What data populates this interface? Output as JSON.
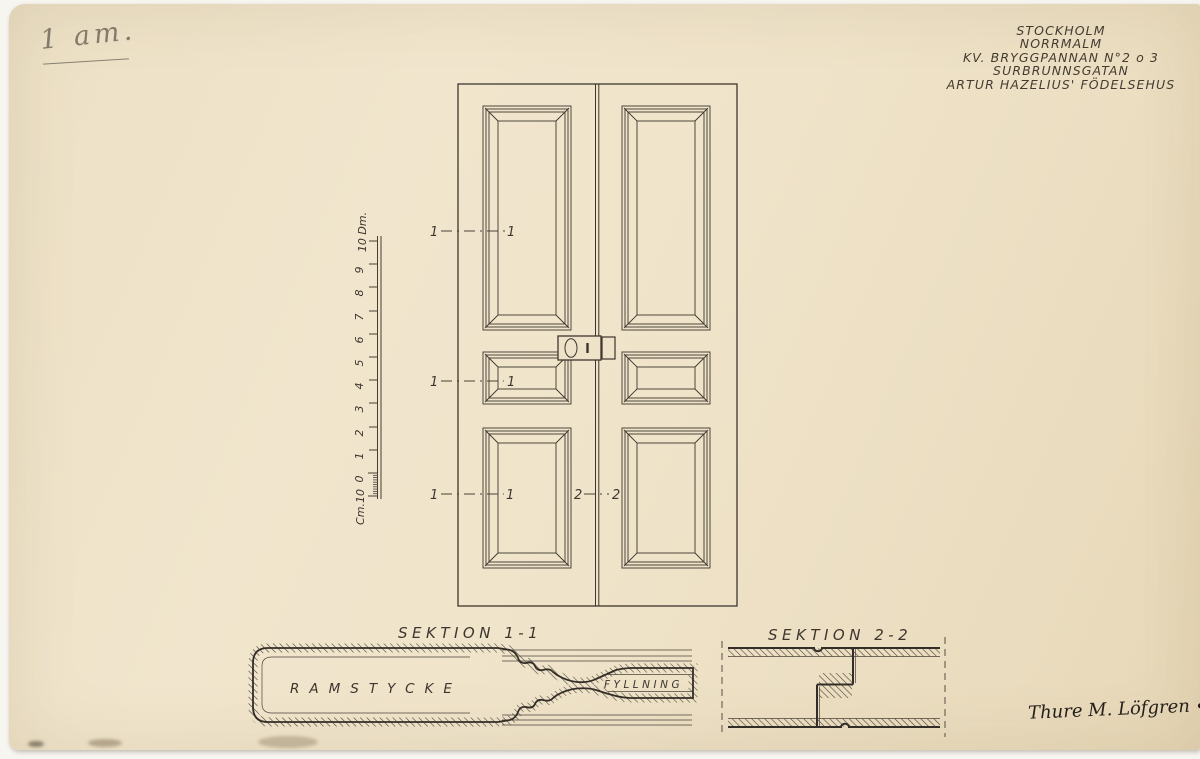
{
  "colors": {
    "paper": "#eee2c8",
    "ink": "#38322b",
    "pencil": "#847b6c"
  },
  "pencil_note": {
    "text": "1 am."
  },
  "title_block": {
    "lines": [
      "STOCKHOLM",
      "NORRMALM",
      "KV. BRYGGPANNAN N°2 o 3",
      "SURBRUNNSGATAN",
      "ARTUR HAZELIUS' FÖDELSEHUS"
    ]
  },
  "scale_ruler": {
    "unit_bottom": "Cm.10",
    "numbers": [
      "0",
      "1",
      "2",
      "3",
      "4",
      "5",
      "6",
      "7",
      "8",
      "9"
    ],
    "unit_top": "10 Dm."
  },
  "elevation": {
    "cut_line_1": "1",
    "cut_line_2": "2"
  },
  "sections": {
    "section1": {
      "title": "SEKTION 1-1",
      "frame_label": "RAMSTYCKE",
      "panel_label": "FYLLNING"
    },
    "section2": {
      "title": "SEKTION 2-2"
    }
  },
  "signature": {
    "name": "Thure M. Löfgren",
    "year": "1925"
  }
}
